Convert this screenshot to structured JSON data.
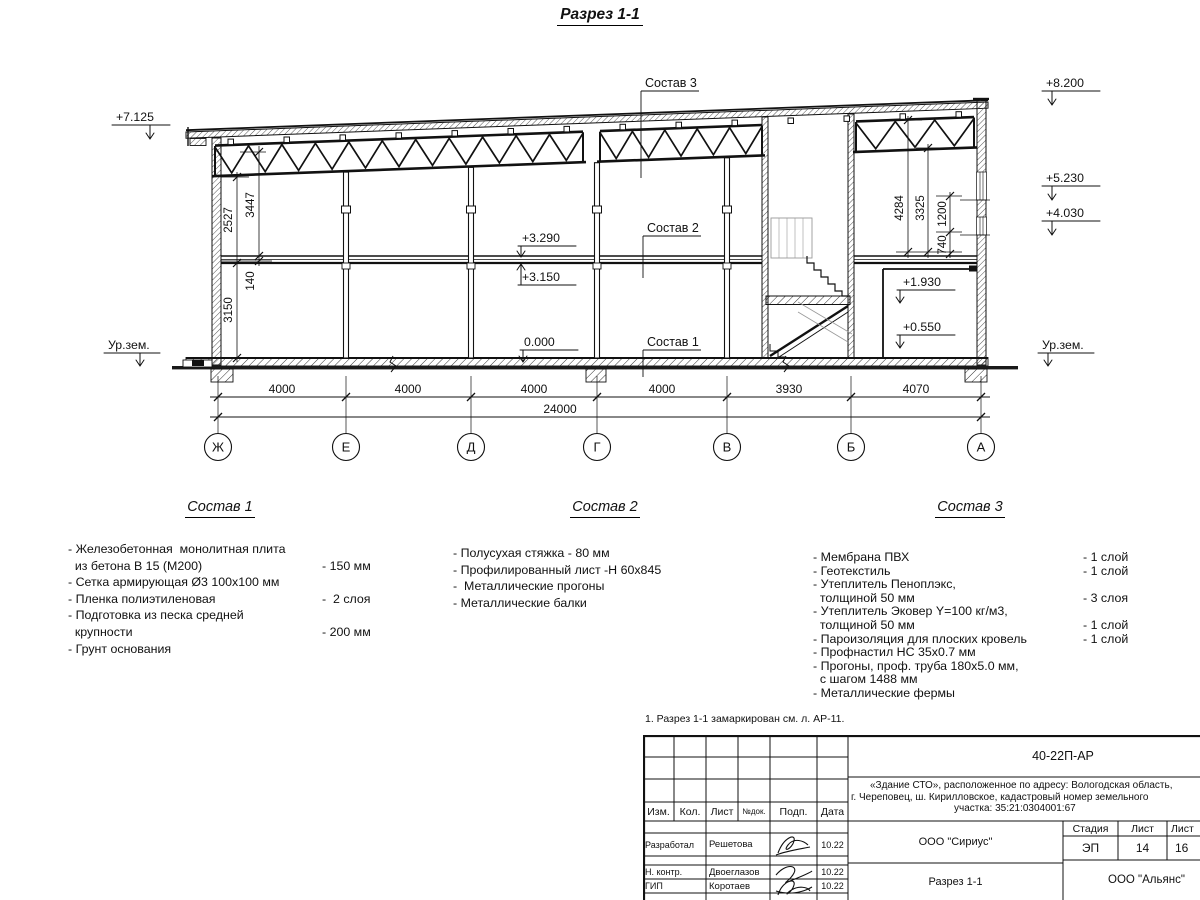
{
  "title": "Разрез 1-1",
  "drawing": {
    "elev": {
      "p7125": "+7.125",
      "p8200": "+8.200",
      "p5230": "+5.230",
      "p4030": "+4.030",
      "p3290": "+3.290",
      "p3150": "+3.150",
      "zero": "0.000",
      "p1930": "+1.930",
      "p0550": "+0.550"
    },
    "ground_left": "Ур.зем.",
    "ground_right": "Ур.зем.",
    "dims_h": [
      "4000",
      "4000",
      "4000",
      "4000",
      "3930",
      "4070"
    ],
    "dim_total": "24000",
    "axes": [
      "Ж",
      "Е",
      "Д",
      "Г",
      "В",
      "Б",
      "А"
    ],
    "dims_v_left": {
      "d2527": "2527",
      "d3447": "3447",
      "d140": "140",
      "d3150": "3150"
    },
    "dims_v_right": {
      "d4284": "4284",
      "d3325": "3325",
      "d1200": "1200",
      "d740": "740"
    },
    "leader_1": "Состав 1",
    "leader_2": "Состав 2",
    "leader_3": "Состав 3"
  },
  "specs": {
    "sections": [
      {
        "title": "Состав 1",
        "items": [
          {
            "text": "- Железобетонная  монолитная плита",
            "value": ""
          },
          {
            "text": "  из бетона В 15 (М200)",
            "value": "- 150 мм"
          },
          {
            "text": "- Сетка армирующая Ø3 100х100 мм",
            "value": ""
          },
          {
            "text": "- Пленка полиэтиленовая",
            "value": "-  2 слоя"
          },
          {
            "text": "- Подготовка из песка средней",
            "value": ""
          },
          {
            "text": "  крупности",
            "value": "- 200 мм"
          },
          {
            "text": "- Грунт основания",
            "value": ""
          }
        ]
      },
      {
        "title": "Состав 2",
        "items": [
          {
            "text": "- Полусухая стяжка - 80 мм",
            "value": ""
          },
          {
            "text": "- Профилированный лист -Н 60х845",
            "value": ""
          },
          {
            "text": "-  Металлические прогоны",
            "value": ""
          },
          {
            "text": "- Металлические балки",
            "value": ""
          }
        ]
      },
      {
        "title": "Состав 3",
        "items": [
          {
            "text": "- Мембрана ПВХ",
            "value": "- 1 слой"
          },
          {
            "text": "- Геотекстиль",
            "value": "- 1 слой"
          },
          {
            "text": "- Утеплитель Пеноплэкс,",
            "value": ""
          },
          {
            "text": "  толщиной 50 мм",
            "value": "- 3 слоя"
          },
          {
            "text": "- Утеплитель Эковер Y=100 кг/м3,",
            "value": ""
          },
          {
            "text": "  толщиной 50 мм",
            "value": "- 1 слой"
          },
          {
            "text": "- Пароизоляция для плоских кровель",
            "value": "- 1 слой"
          },
          {
            "text": "- Профнастил НС 35х0.7 мм",
            "value": ""
          },
          {
            "text": "- Прогоны, проф. труба 180х5.0 мм,",
            "value": ""
          },
          {
            "text": "  с шагом 1488 мм",
            "value": ""
          },
          {
            "text": "- Металлические фермы",
            "value": ""
          }
        ]
      }
    ]
  },
  "note": "1. Разрез 1-1 замаркирован см. л. АР-11.",
  "titleblock": {
    "doc_number": "40-22П-АР",
    "address_lines": [
      "«Здание СТО», расположенное по адресу: Вологодская область,",
      "г. Череповец, ш. Кирилловское, кадастровый номер земельного",
      "участка: 35:21:0304001:67"
    ],
    "cols": {
      "izm": "Изм.",
      "kol": "Кол.",
      "list": "Лист",
      "ndok": "№док.",
      "podp": "Подп.",
      "data": "Дата"
    },
    "rows": [
      {
        "role": "Разработал",
        "name": "Решетова",
        "date": "10.22"
      },
      {
        "role": "Н. контр.",
        "name": "Двоеглазов",
        "date": "10.22"
      },
      {
        "role": "ГИП",
        "name": "Коротаев",
        "date": "10.22"
      }
    ],
    "org": "ООО \"Сириус\"",
    "sheet_title": "Разрез 1-1",
    "stage_label": "Стадия",
    "sheet_label": "Лист",
    "sheets_label": "Лист",
    "stage": "ЭП",
    "sheet_num": "14",
    "sheets_total": "16",
    "company": "ООО \"Альянс\""
  }
}
